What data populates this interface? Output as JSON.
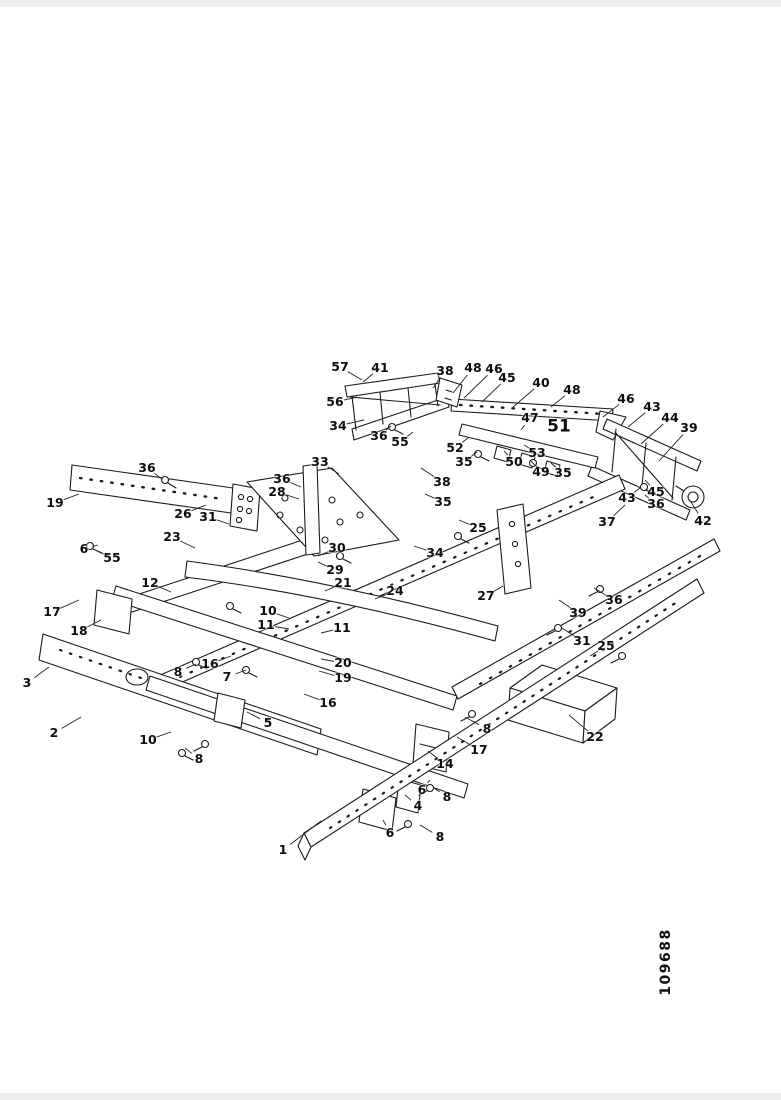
{
  "document": {
    "figure_number": "109688"
  },
  "drawing": {
    "ink_color": "#1b1b1b",
    "leader_color": "#222222",
    "background": "#ffffff"
  },
  "callouts": [
    {
      "label": "57",
      "x": 340,
      "y": 367,
      "lx": 362,
      "ly": 380
    },
    {
      "label": "41",
      "x": 380,
      "y": 368,
      "lx": 363,
      "ly": 382
    },
    {
      "label": "38",
      "x": 445,
      "y": 371,
      "lx": 433,
      "ly": 388
    },
    {
      "label": "48",
      "x": 473,
      "y": 368,
      "lx": 453,
      "ly": 393
    },
    {
      "label": "46",
      "x": 494,
      "y": 369,
      "lx": 464,
      "ly": 398
    },
    {
      "label": "45",
      "x": 507,
      "y": 378,
      "lx": 482,
      "ly": 402
    },
    {
      "label": "40",
      "x": 541,
      "y": 383,
      "lx": 513,
      "ly": 407
    },
    {
      "label": "48",
      "x": 572,
      "y": 390,
      "lx": 551,
      "ly": 407
    },
    {
      "label": "46",
      "x": 626,
      "y": 399,
      "lx": 603,
      "ly": 417
    },
    {
      "label": "43",
      "x": 652,
      "y": 407,
      "lx": 628,
      "ly": 427
    },
    {
      "label": "44",
      "x": 670,
      "y": 418,
      "lx": 641,
      "ly": 444
    },
    {
      "label": "39",
      "x": 689,
      "y": 428,
      "lx": 659,
      "ly": 461
    },
    {
      "label": "56",
      "x": 335,
      "y": 402,
      "lx": 357,
      "ly": 397
    },
    {
      "label": "34",
      "x": 338,
      "y": 426,
      "lx": 364,
      "ly": 420
    },
    {
      "label": "36",
      "x": 379,
      "y": 436,
      "lx": 391,
      "ly": 426
    },
    {
      "label": "55",
      "x": 400,
      "y": 442,
      "lx": 413,
      "ly": 432
    },
    {
      "label": "52",
      "x": 455,
      "y": 448,
      "lx": 468,
      "ly": 438
    },
    {
      "label": "35",
      "x": 464,
      "y": 462,
      "lx": 477,
      "ly": 452
    },
    {
      "label": "47",
      "x": 530,
      "y": 418,
      "lx": 521,
      "ly": 430
    },
    {
      "label": "51",
      "x": 559,
      "y": 427,
      "big": true
    },
    {
      "label": "53",
      "x": 537,
      "y": 453,
      "lx": 524,
      "ly": 445
    },
    {
      "label": "50",
      "x": 514,
      "y": 462,
      "lx": 504,
      "ly": 451
    },
    {
      "label": "49",
      "x": 541,
      "y": 472,
      "lx": 531,
      "ly": 461
    },
    {
      "label": "35",
      "x": 563,
      "y": 473,
      "lx": 551,
      "ly": 463
    },
    {
      "label": "38",
      "x": 442,
      "y": 482,
      "lx": 421,
      "ly": 468
    },
    {
      "label": "35",
      "x": 443,
      "y": 502,
      "lx": 425,
      "ly": 494
    },
    {
      "label": "33",
      "x": 320,
      "y": 462,
      "lx": 339,
      "ly": 474
    },
    {
      "label": "36",
      "x": 282,
      "y": 479,
      "lx": 301,
      "ly": 487
    },
    {
      "label": "28",
      "x": 277,
      "y": 492,
      "lx": 299,
      "ly": 499
    },
    {
      "label": "25",
      "x": 478,
      "y": 528,
      "lx": 459,
      "ly": 520
    },
    {
      "label": "34",
      "x": 435,
      "y": 553,
      "lx": 414,
      "ly": 546
    },
    {
      "label": "27",
      "x": 486,
      "y": 596,
      "lx": 503,
      "ly": 586
    },
    {
      "label": "36",
      "x": 147,
      "y": 468,
      "lx": 162,
      "ly": 479
    },
    {
      "label": "19",
      "x": 55,
      "y": 503,
      "lx": 79,
      "ly": 494
    },
    {
      "label": "26",
      "x": 183,
      "y": 514,
      "lx": 206,
      "ly": 505
    },
    {
      "label": "31",
      "x": 208,
      "y": 517,
      "lx": 229,
      "ly": 524
    },
    {
      "label": "23",
      "x": 172,
      "y": 537,
      "lx": 195,
      "ly": 548
    },
    {
      "label": "6",
      "x": 84,
      "y": 549,
      "lx": 98,
      "ly": 545
    },
    {
      "label": "55",
      "x": 112,
      "y": 558,
      "lx": 97,
      "ly": 551
    },
    {
      "label": "17",
      "x": 52,
      "y": 612,
      "lx": 79,
      "ly": 600
    },
    {
      "label": "18",
      "x": 79,
      "y": 631,
      "lx": 101,
      "ly": 620
    },
    {
      "label": "12",
      "x": 150,
      "y": 583,
      "lx": 171,
      "ly": 592
    },
    {
      "label": "30",
      "x": 337,
      "y": 548,
      "lx": 318,
      "ly": 556
    },
    {
      "label": "29",
      "x": 335,
      "y": 570,
      "lx": 318,
      "ly": 562
    },
    {
      "label": "21",
      "x": 343,
      "y": 583,
      "lx": 325,
      "ly": 591
    },
    {
      "label": "24",
      "x": 395,
      "y": 591,
      "lx": 375,
      "ly": 599
    },
    {
      "label": "10",
      "x": 268,
      "y": 611,
      "lx": 289,
      "ly": 618
    },
    {
      "label": "11",
      "x": 266,
      "y": 625,
      "lx": 289,
      "ly": 629
    },
    {
      "label": "11",
      "x": 342,
      "y": 628,
      "lx": 321,
      "ly": 633
    },
    {
      "label": "20",
      "x": 343,
      "y": 663,
      "lx": 321,
      "ly": 659
    },
    {
      "label": "19",
      "x": 343,
      "y": 678,
      "lx": 319,
      "ly": 671
    },
    {
      "label": "16",
      "x": 328,
      "y": 703,
      "lx": 304,
      "ly": 694
    },
    {
      "label": "16",
      "x": 210,
      "y": 664,
      "lx": 231,
      "ly": 656
    },
    {
      "label": "8",
      "x": 178,
      "y": 672,
      "lx": 196,
      "ly": 664
    },
    {
      "label": "7",
      "x": 227,
      "y": 677,
      "lx": 246,
      "ly": 670
    },
    {
      "label": "3",
      "x": 27,
      "y": 683,
      "lx": 49,
      "ly": 667
    },
    {
      "label": "2",
      "x": 54,
      "y": 733,
      "lx": 81,
      "ly": 717
    },
    {
      "label": "5",
      "x": 268,
      "y": 723,
      "lx": 247,
      "ly": 712
    },
    {
      "label": "10",
      "x": 148,
      "y": 740,
      "lx": 171,
      "ly": 732
    },
    {
      "label": "8",
      "x": 199,
      "y": 759,
      "lx": 185,
      "ly": 748
    },
    {
      "label": "8",
      "x": 487,
      "y": 729,
      "lx": 465,
      "ly": 717
    },
    {
      "label": "17",
      "x": 479,
      "y": 750,
      "lx": 457,
      "ly": 737
    },
    {
      "label": "14",
      "x": 445,
      "y": 764,
      "lx": 428,
      "ly": 751
    },
    {
      "label": "6",
      "x": 422,
      "y": 790,
      "lx": 430,
      "ly": 780
    },
    {
      "label": "8",
      "x": 447,
      "y": 797,
      "lx": 434,
      "ly": 788
    },
    {
      "label": "4",
      "x": 418,
      "y": 806,
      "lx": 405,
      "ly": 795
    },
    {
      "label": "6",
      "x": 390,
      "y": 833,
      "lx": 383,
      "ly": 820
    },
    {
      "label": "8",
      "x": 440,
      "y": 837,
      "lx": 420,
      "ly": 825
    },
    {
      "label": "1",
      "x": 283,
      "y": 850,
      "lx": 321,
      "ly": 821
    },
    {
      "label": "22",
      "x": 595,
      "y": 737,
      "lx": 569,
      "ly": 715
    },
    {
      "label": "39",
      "x": 578,
      "y": 613,
      "lx": 559,
      "ly": 600
    },
    {
      "label": "36",
      "x": 614,
      "y": 600,
      "lx": 594,
      "ly": 588
    },
    {
      "label": "31",
      "x": 582,
      "y": 641,
      "lx": 562,
      "ly": 628
    },
    {
      "label": "25",
      "x": 606,
      "y": 646,
      "lx": 590,
      "ly": 656
    },
    {
      "label": "37",
      "x": 607,
      "y": 522,
      "lx": 625,
      "ly": 505
    },
    {
      "label": "42",
      "x": 703,
      "y": 521,
      "lx": 691,
      "ly": 502
    },
    {
      "label": "43",
      "x": 627,
      "y": 498,
      "lx": 640,
      "ly": 488
    },
    {
      "label": "45",
      "x": 656,
      "y": 492,
      "lx": 645,
      "ly": 480
    },
    {
      "label": "36",
      "x": 656,
      "y": 504,
      "lx": 645,
      "ly": 495
    }
  ]
}
